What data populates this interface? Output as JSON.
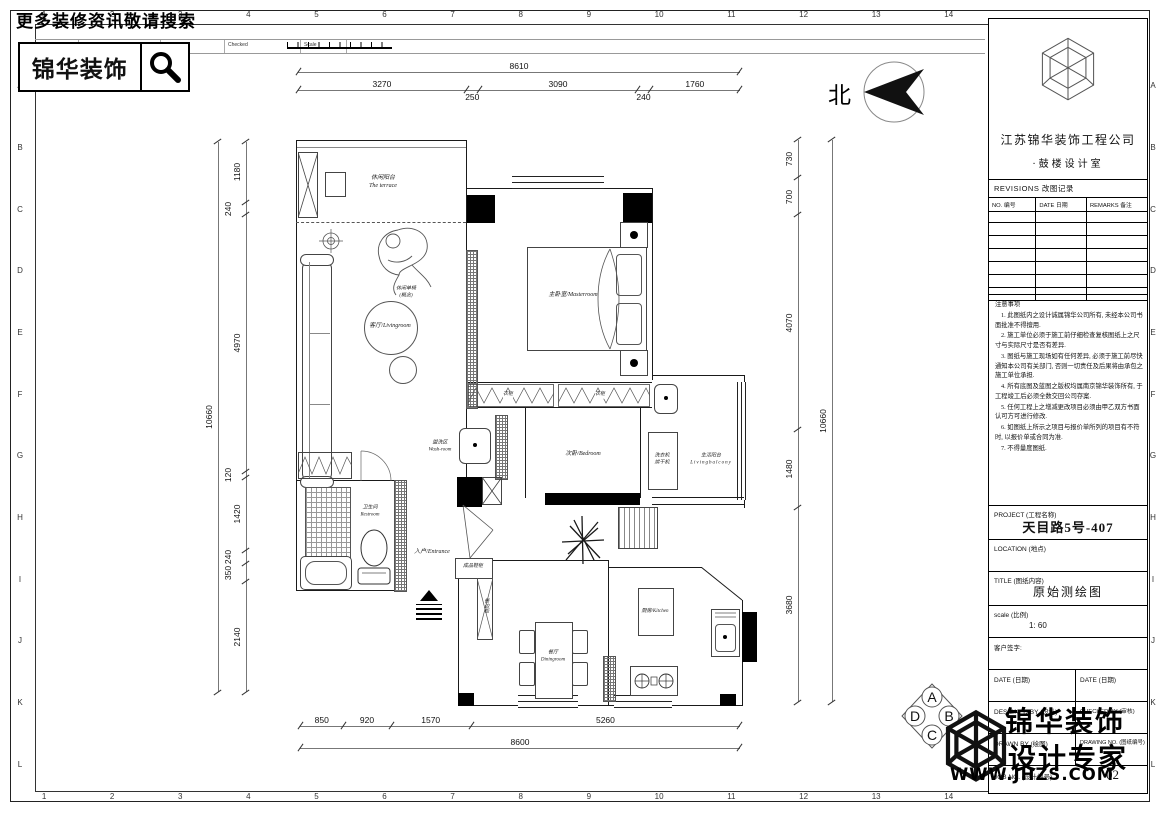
{
  "header": {
    "search_text": "更多装修资讯敬请搜索",
    "logo_text": "锦华装饰",
    "strip": {
      "rev_no": "Rev.No",
      "revision_note": "Revision note",
      "signature": "Signature",
      "checked": "Checked",
      "scale": "Scale"
    }
  },
  "north": {
    "label": "北"
  },
  "grid": {
    "columns": [
      "1",
      "2",
      "3",
      "4",
      "5",
      "6",
      "7",
      "8",
      "9",
      "10",
      "11",
      "12",
      "13",
      "14"
    ],
    "rows": [
      "A",
      "B",
      "C",
      "D",
      "E",
      "F",
      "G",
      "H",
      "I",
      "J",
      "K",
      "L"
    ]
  },
  "orientation_badge": {
    "top": "A",
    "right": "B",
    "bottom": "C",
    "left": "D"
  },
  "plan": {
    "rooms": {
      "terrace": {
        "cn": "休闲阳台",
        "en": "The terrace"
      },
      "chair": {
        "cn": "休闲单椅",
        "en": "(概念)"
      },
      "living": {
        "label": "客厅/Livingroom"
      },
      "master": {
        "label": "主卧室/Masterroom"
      },
      "wash": {
        "cn": "盥洗区",
        "en": "Wash-room"
      },
      "bedroom": {
        "label": "次卧/Bedroom"
      },
      "laundry": {
        "line1": "洗衣机",
        "line2": "烘干机"
      },
      "balcony": {
        "cn": "生活阳台",
        "en": "Livingbalcony"
      },
      "restroom": {
        "cn": "卫生间",
        "en": "Restroom"
      },
      "entrance": {
        "label": "入户/Entrance"
      },
      "shoe_cabinet": {
        "label": "成品鞋柜"
      },
      "sideboard": {
        "label": "餐边柜"
      },
      "dining": {
        "cn": "餐厅",
        "en": "Diningroom"
      },
      "kitchen": {
        "label": "厨房/Kitchen"
      },
      "wardrobe": {
        "label": "衣柜"
      }
    },
    "dimensions": {
      "top_total": "8610",
      "top_segments": [
        "3270",
        "250",
        "3090",
        "240",
        "1760"
      ],
      "left_total": "10660",
      "left_segments": [
        "1180",
        "240",
        "4970",
        "120",
        "1420",
        "240",
        "350",
        "2140"
      ],
      "right_total": "10660",
      "right_segments": [
        "730",
        "700",
        "4070",
        "1480",
        "3680"
      ],
      "bottom_total": "8600",
      "bottom_segments": [
        "850",
        "920",
        "1570",
        "5260"
      ]
    }
  },
  "sidebar": {
    "company_line1": "江苏锦华装饰工程公司",
    "company_line2": "·鼓楼设计室",
    "revisions": {
      "title": "REVISIONS 改图记录",
      "columns": [
        "NO. 编号",
        "DATE 日期",
        "REMARKS 备注"
      ],
      "empty_rows": 7
    },
    "notes_title": "注意事项",
    "notes": [
      "1. 此图纸内之设计诚属锦华公司所有, 未经本公司书面批准不得擅用.",
      "2. 施工单位必须于施工前仔细检查复核图纸上之尺寸与实际尺寸是否有差异.",
      "3. 图纸与施工现场如有任何差异, 必须于施工前尽快通知本公司有关部门, 否则一切责任及后果将由承包之施工单位承担.",
      "4. 所有底图及蓝图之版权均属南京锦华装饰所有, 于工程竣工后必须全数交回公司存案.",
      "5. 任何工程上之增减更改项目必须由甲乙双方书面认可方可进行修改.",
      "6. 如图纸上所示之项目与报价单所列的项目有不符时, 以报价单或合同为准.",
      "7. 不得量度图纸."
    ],
    "project_label": "PROJECT (工程名称)",
    "project_value": "天目路5号-407",
    "location_label": "LOCATION (地点)",
    "title_label": "TITLE (图纸内容)",
    "title_value": "原始测绘图",
    "scale_label": "scale (比例)",
    "scale_value": "1: 60",
    "client_sign_label": "客户签字:",
    "date_label_left": "DATE (日期)",
    "date_label_right": "DATE (日期)",
    "designed_by_label": "DESIGNED BY (设计)",
    "checked_by_label": "CHECKED BY (审核)",
    "drawn_by_label": "DRAWN BY (绘图)",
    "drawing_no_label": "DRAWING NO. (图纸编号)",
    "job_no_label": "JOB NO. (设计编号)",
    "page_no": "02"
  },
  "watermark": {
    "line1": "锦华装饰",
    "line2": "设计专家",
    "url": "WWW.JHZS.COM"
  }
}
